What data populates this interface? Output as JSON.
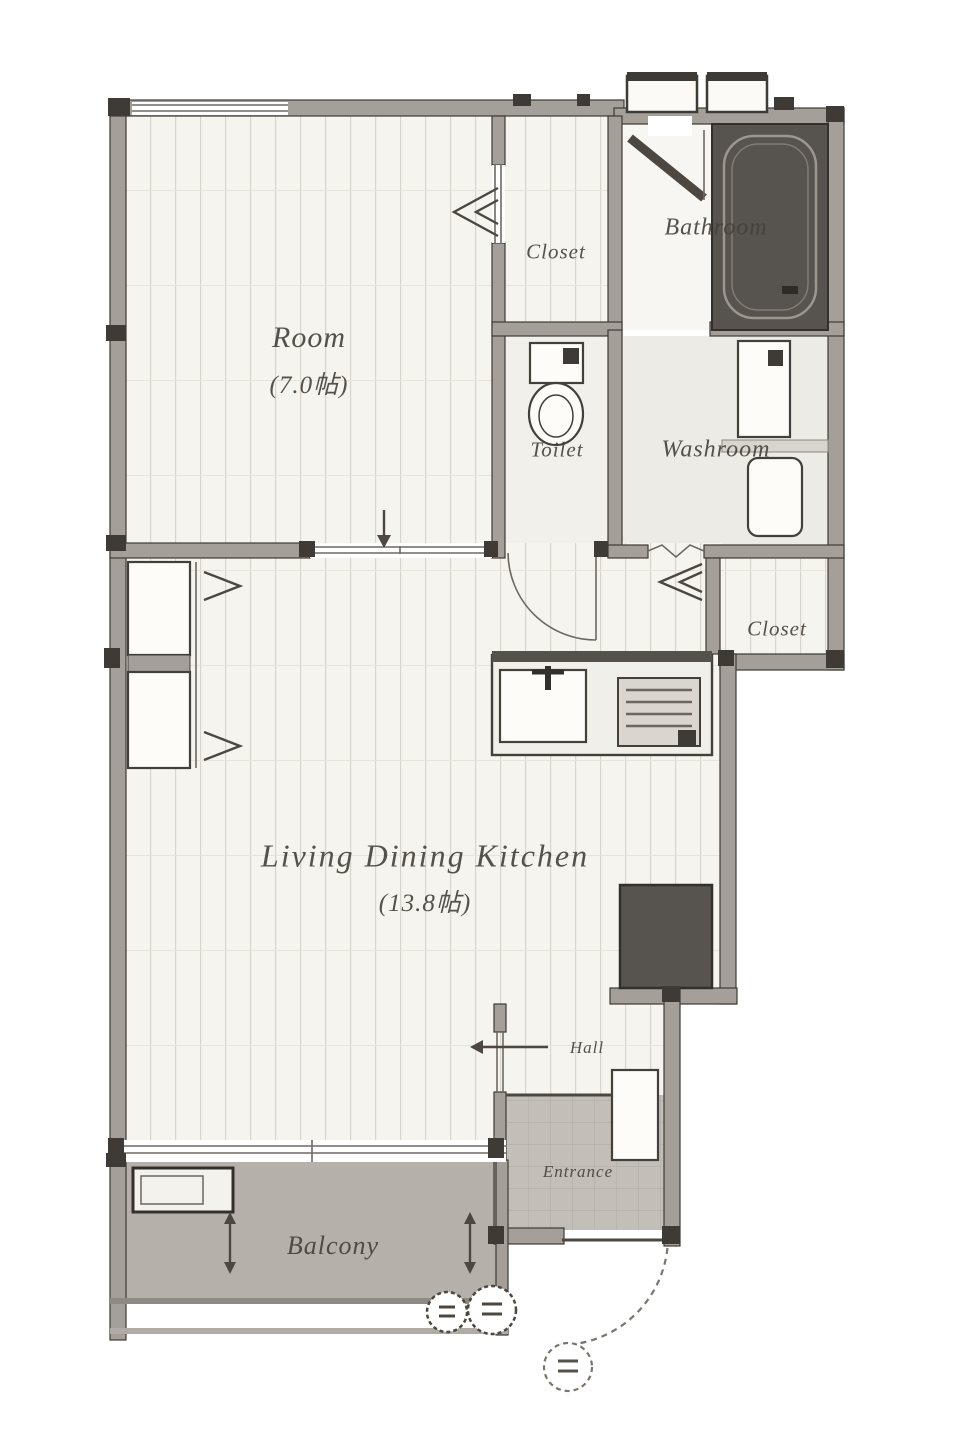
{
  "rooms": {
    "room": {
      "label": "Room",
      "size": "(7.0帖)"
    },
    "closet_top": {
      "label": "Closet"
    },
    "bathroom": {
      "label": "Bathroom"
    },
    "toilet": {
      "label": "Toilet"
    },
    "washroom": {
      "label": "Washroom"
    },
    "closet_mid": {
      "label": "Closet"
    },
    "ldk": {
      "label": "Living  Dining  Kitchen",
      "size": "(13.8帖)"
    },
    "hall": {
      "label": "Hall"
    },
    "entrance": {
      "label": "Entrance"
    },
    "balcony": {
      "label": "Balcony"
    }
  },
  "colors": {
    "wall": "#a4a099",
    "wall_edge": "#3e3b36",
    "floor": "#f6f4ef",
    "stripe": "#d9d5cd",
    "plain_floor": "#efede7",
    "balcony": "#b5b1aa",
    "entrance_tile": "#c3bfb8",
    "tub": "#57534e",
    "fixture": "#433f39",
    "label": "#44403a"
  }
}
